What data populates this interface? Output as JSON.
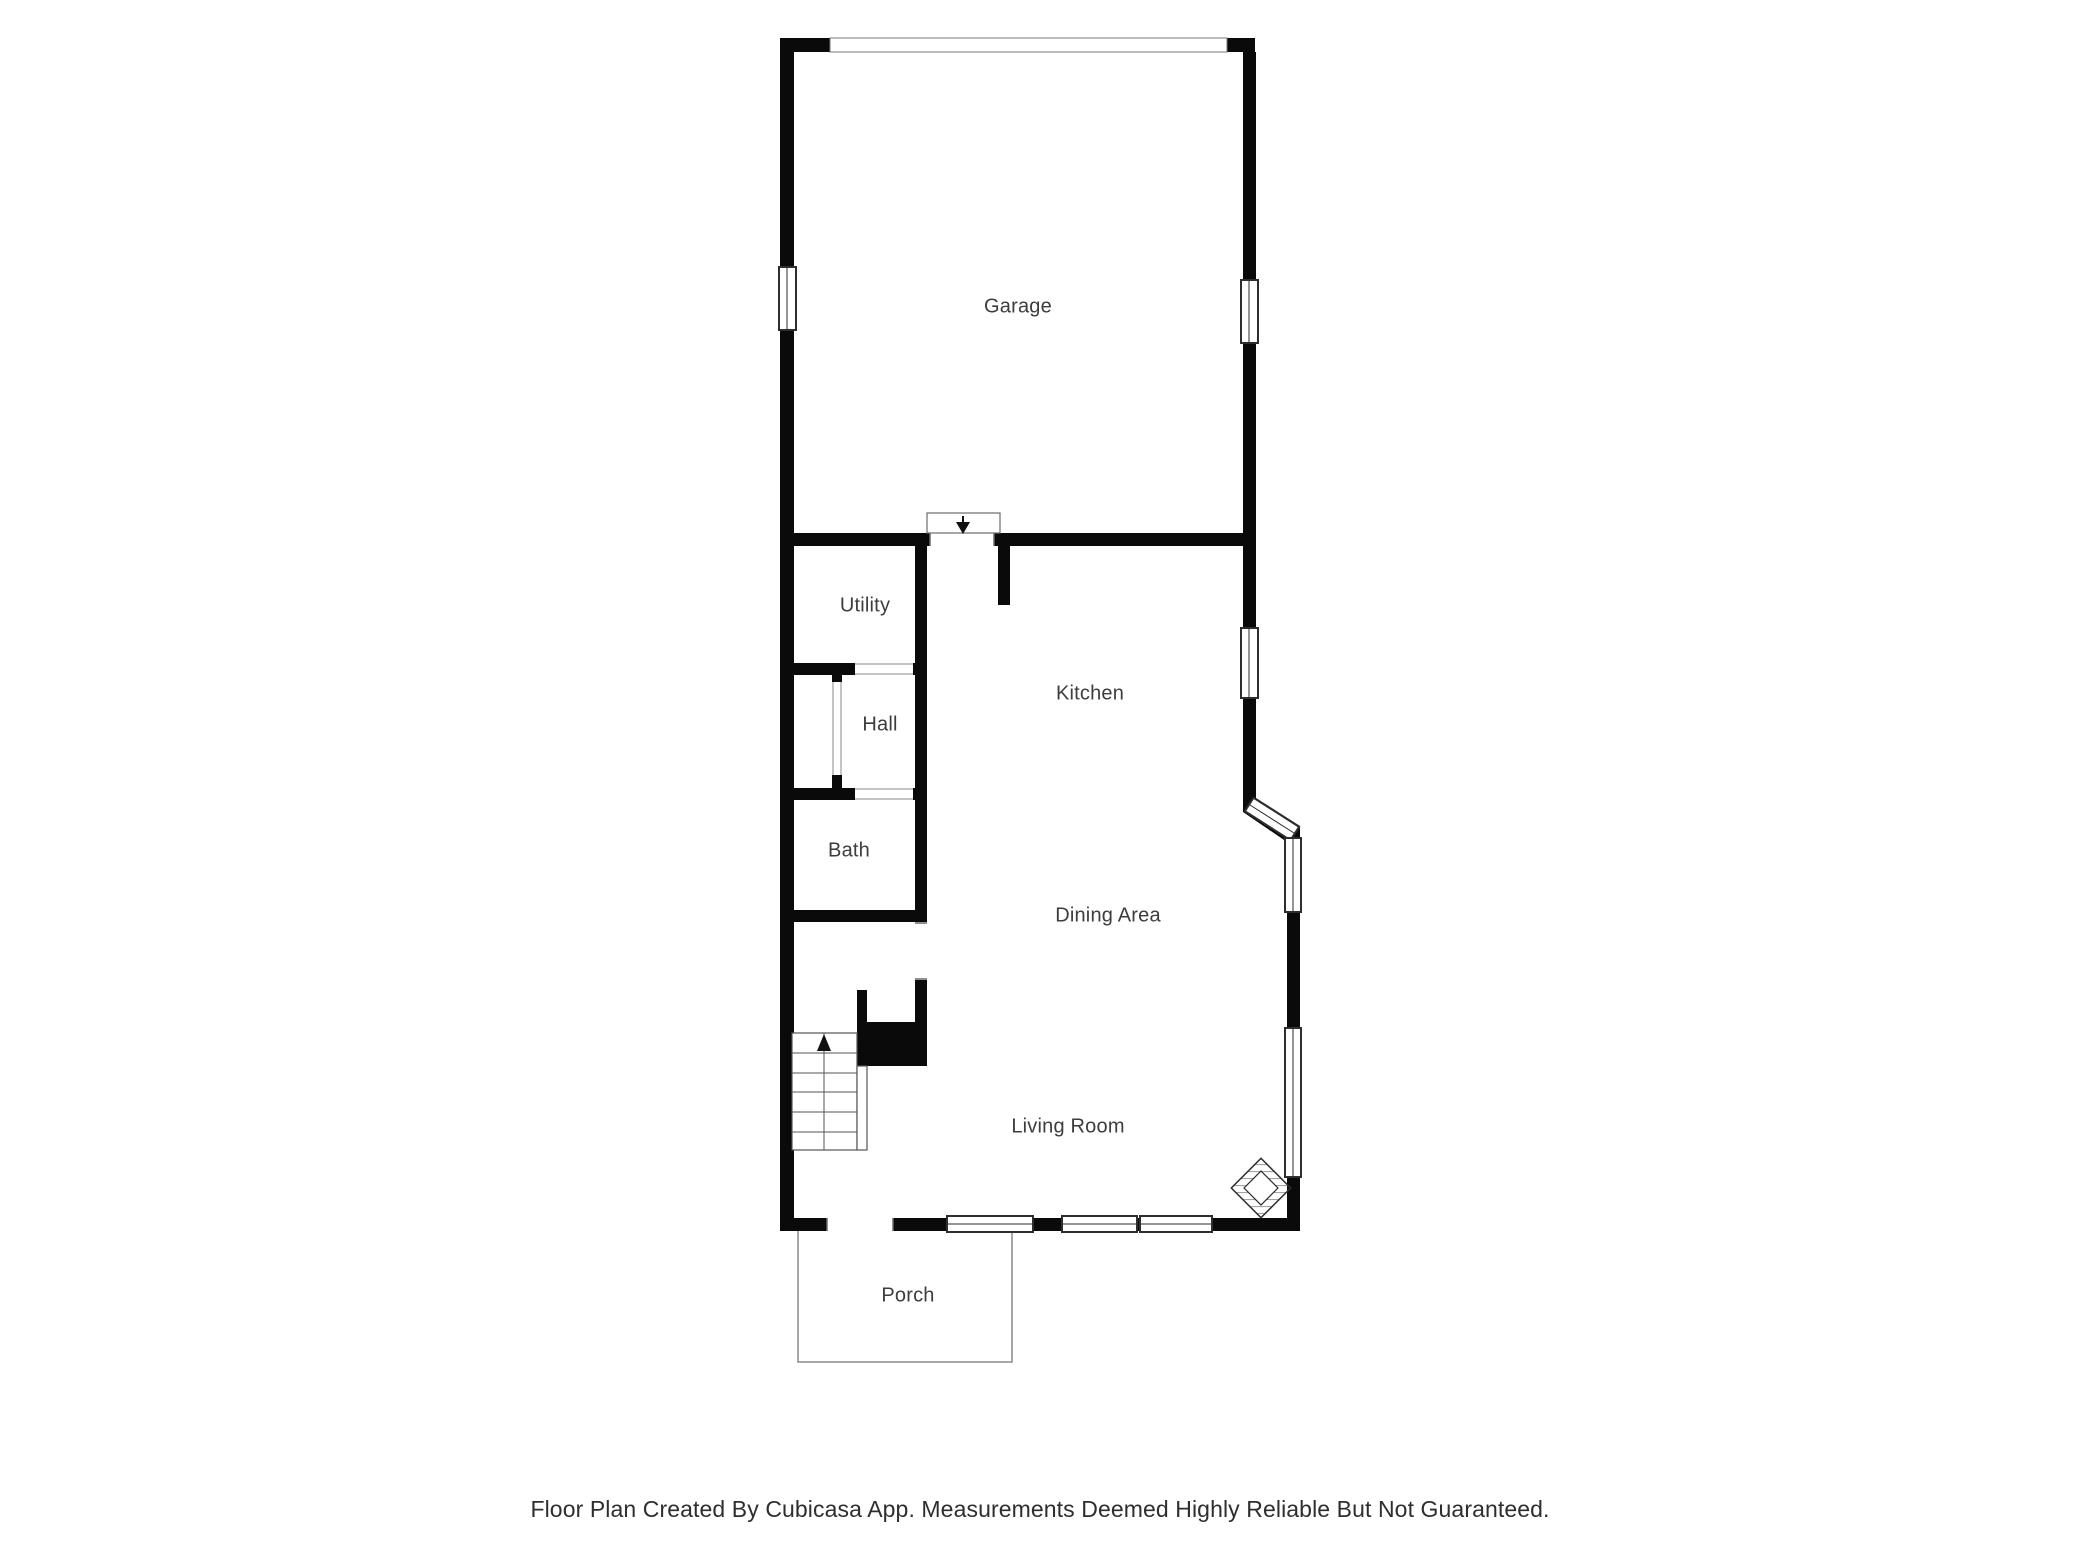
{
  "title": "Floor plan",
  "rooms": {
    "garage": {
      "label": "Garage"
    },
    "utility": {
      "label": "Utility"
    },
    "hall": {
      "label": "Hall"
    },
    "bath": {
      "label": "Bath"
    },
    "kitchen": {
      "label": "Kitchen"
    },
    "dining": {
      "label": "Dining Area"
    },
    "living": {
      "label": "Living Room"
    },
    "porch": {
      "label": "Porch"
    }
  },
  "footer": {
    "disclaimer": "Floor Plan Created By Cubicasa App. Measurements Deemed Highly Reliable But Not Guaranteed."
  },
  "icons": {
    "stair_direction": "arrow-up",
    "garage_entry_door": "arrow-down",
    "fireplace": "hatched-diamond",
    "window": "double-line-rect",
    "garage_door": "thin-outline-band"
  },
  "colors": {
    "wall": "#0a0a0a",
    "frame": "#2e2e2e",
    "thin_line": "#6b6b6b",
    "label_text": "#3d3d3d",
    "footer_text": "#2e2e2e",
    "background": "#ffffff"
  }
}
